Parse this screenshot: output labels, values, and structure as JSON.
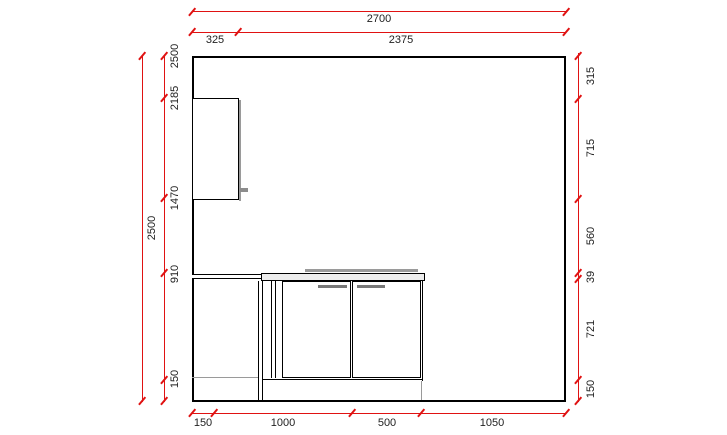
{
  "colors": {
    "dimension_line": "#e01212",
    "drawing_outline": "#000000",
    "shadow_gray": "#9a9a9a",
    "label_text": "#222222",
    "background": "#ffffff"
  },
  "dims": {
    "top_total": "2700",
    "top_segments": [
      "325",
      "2375"
    ],
    "left_overall": "2500",
    "left_marks": [
      "2500",
      "2185",
      "1470",
      "910",
      "150"
    ],
    "right_segments": [
      "315",
      "715",
      "560",
      "39",
      "721",
      "150"
    ],
    "bottom_segments": [
      "150",
      "1000",
      "500",
      "1050"
    ]
  }
}
